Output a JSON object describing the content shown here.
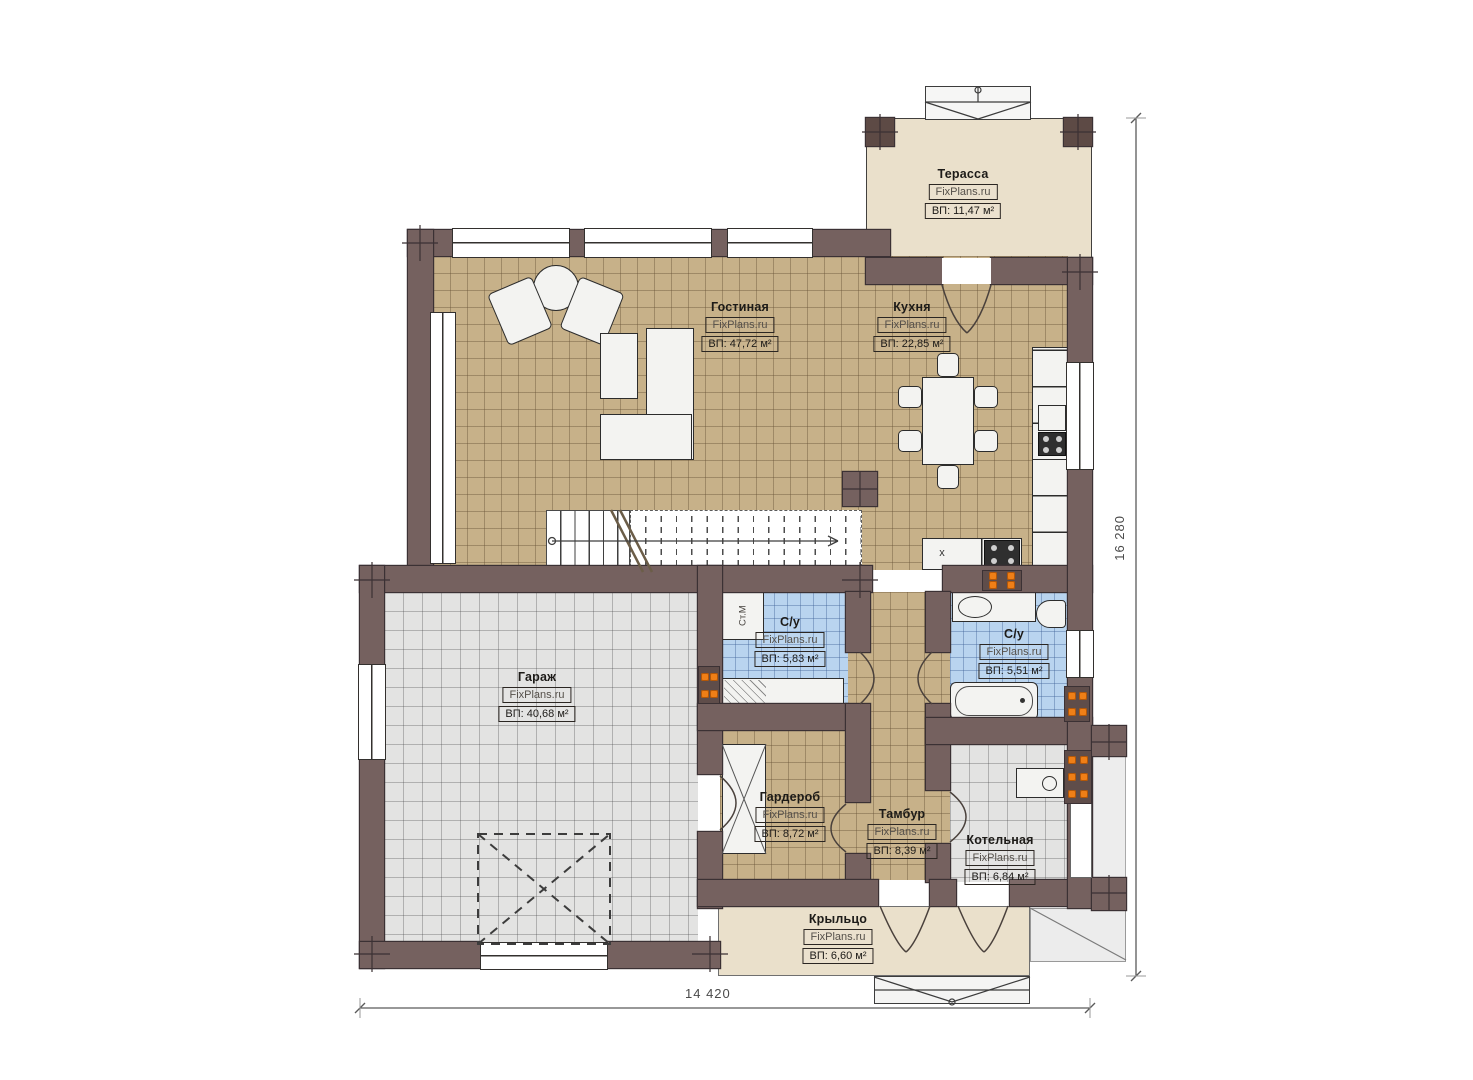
{
  "plan": {
    "title": "План первого этажа",
    "rooms": [
      {
        "name": "Терасса",
        "watermark": "FixPlans.ru",
        "area": "ВП: 11,47 м²"
      },
      {
        "name": "Гостиная",
        "watermark": "FixPlans.ru",
        "area": "ВП: 47,72 м²"
      },
      {
        "name": "Кухня",
        "watermark": "FixPlans.ru",
        "area": "ВП: 22,85 м²"
      },
      {
        "name": "Гараж",
        "watermark": "FixPlans.ru",
        "area": "ВП: 40,68 м²"
      },
      {
        "name": "С/у",
        "watermark": "FixPlans.ru",
        "area": "ВП: 5,83 м²"
      },
      {
        "name": "С/у",
        "watermark": "FixPlans.ru",
        "area": "ВП: 5,51 м²"
      },
      {
        "name": "Гардероб",
        "watermark": "FixPlans.ru",
        "area": "ВП: 8,72 м²"
      },
      {
        "name": "Тамбур",
        "watermark": "FixPlans.ru",
        "area": "ВП: 8,39 м²"
      },
      {
        "name": "Котельная",
        "watermark": "FixPlans.ru",
        "area": "ВП: 6,84 м²"
      },
      {
        "name": "Крыльцо",
        "watermark": "FixPlans.ru",
        "area": "ВП: 6,60 м²"
      }
    ],
    "dimensions": {
      "width": "14 420",
      "height": "16 280"
    },
    "annotations": {
      "washing_machine": "Ст.М",
      "cabinet_marker": "x"
    },
    "colors": {
      "wall": "#75615f",
      "wood_floor": "#c7b189",
      "garage_tile": "#e3e3e2",
      "bath_tile": "#b9d4ef",
      "terrace": "#eae0cb",
      "radiator_accent": "#ef7f17"
    }
  }
}
